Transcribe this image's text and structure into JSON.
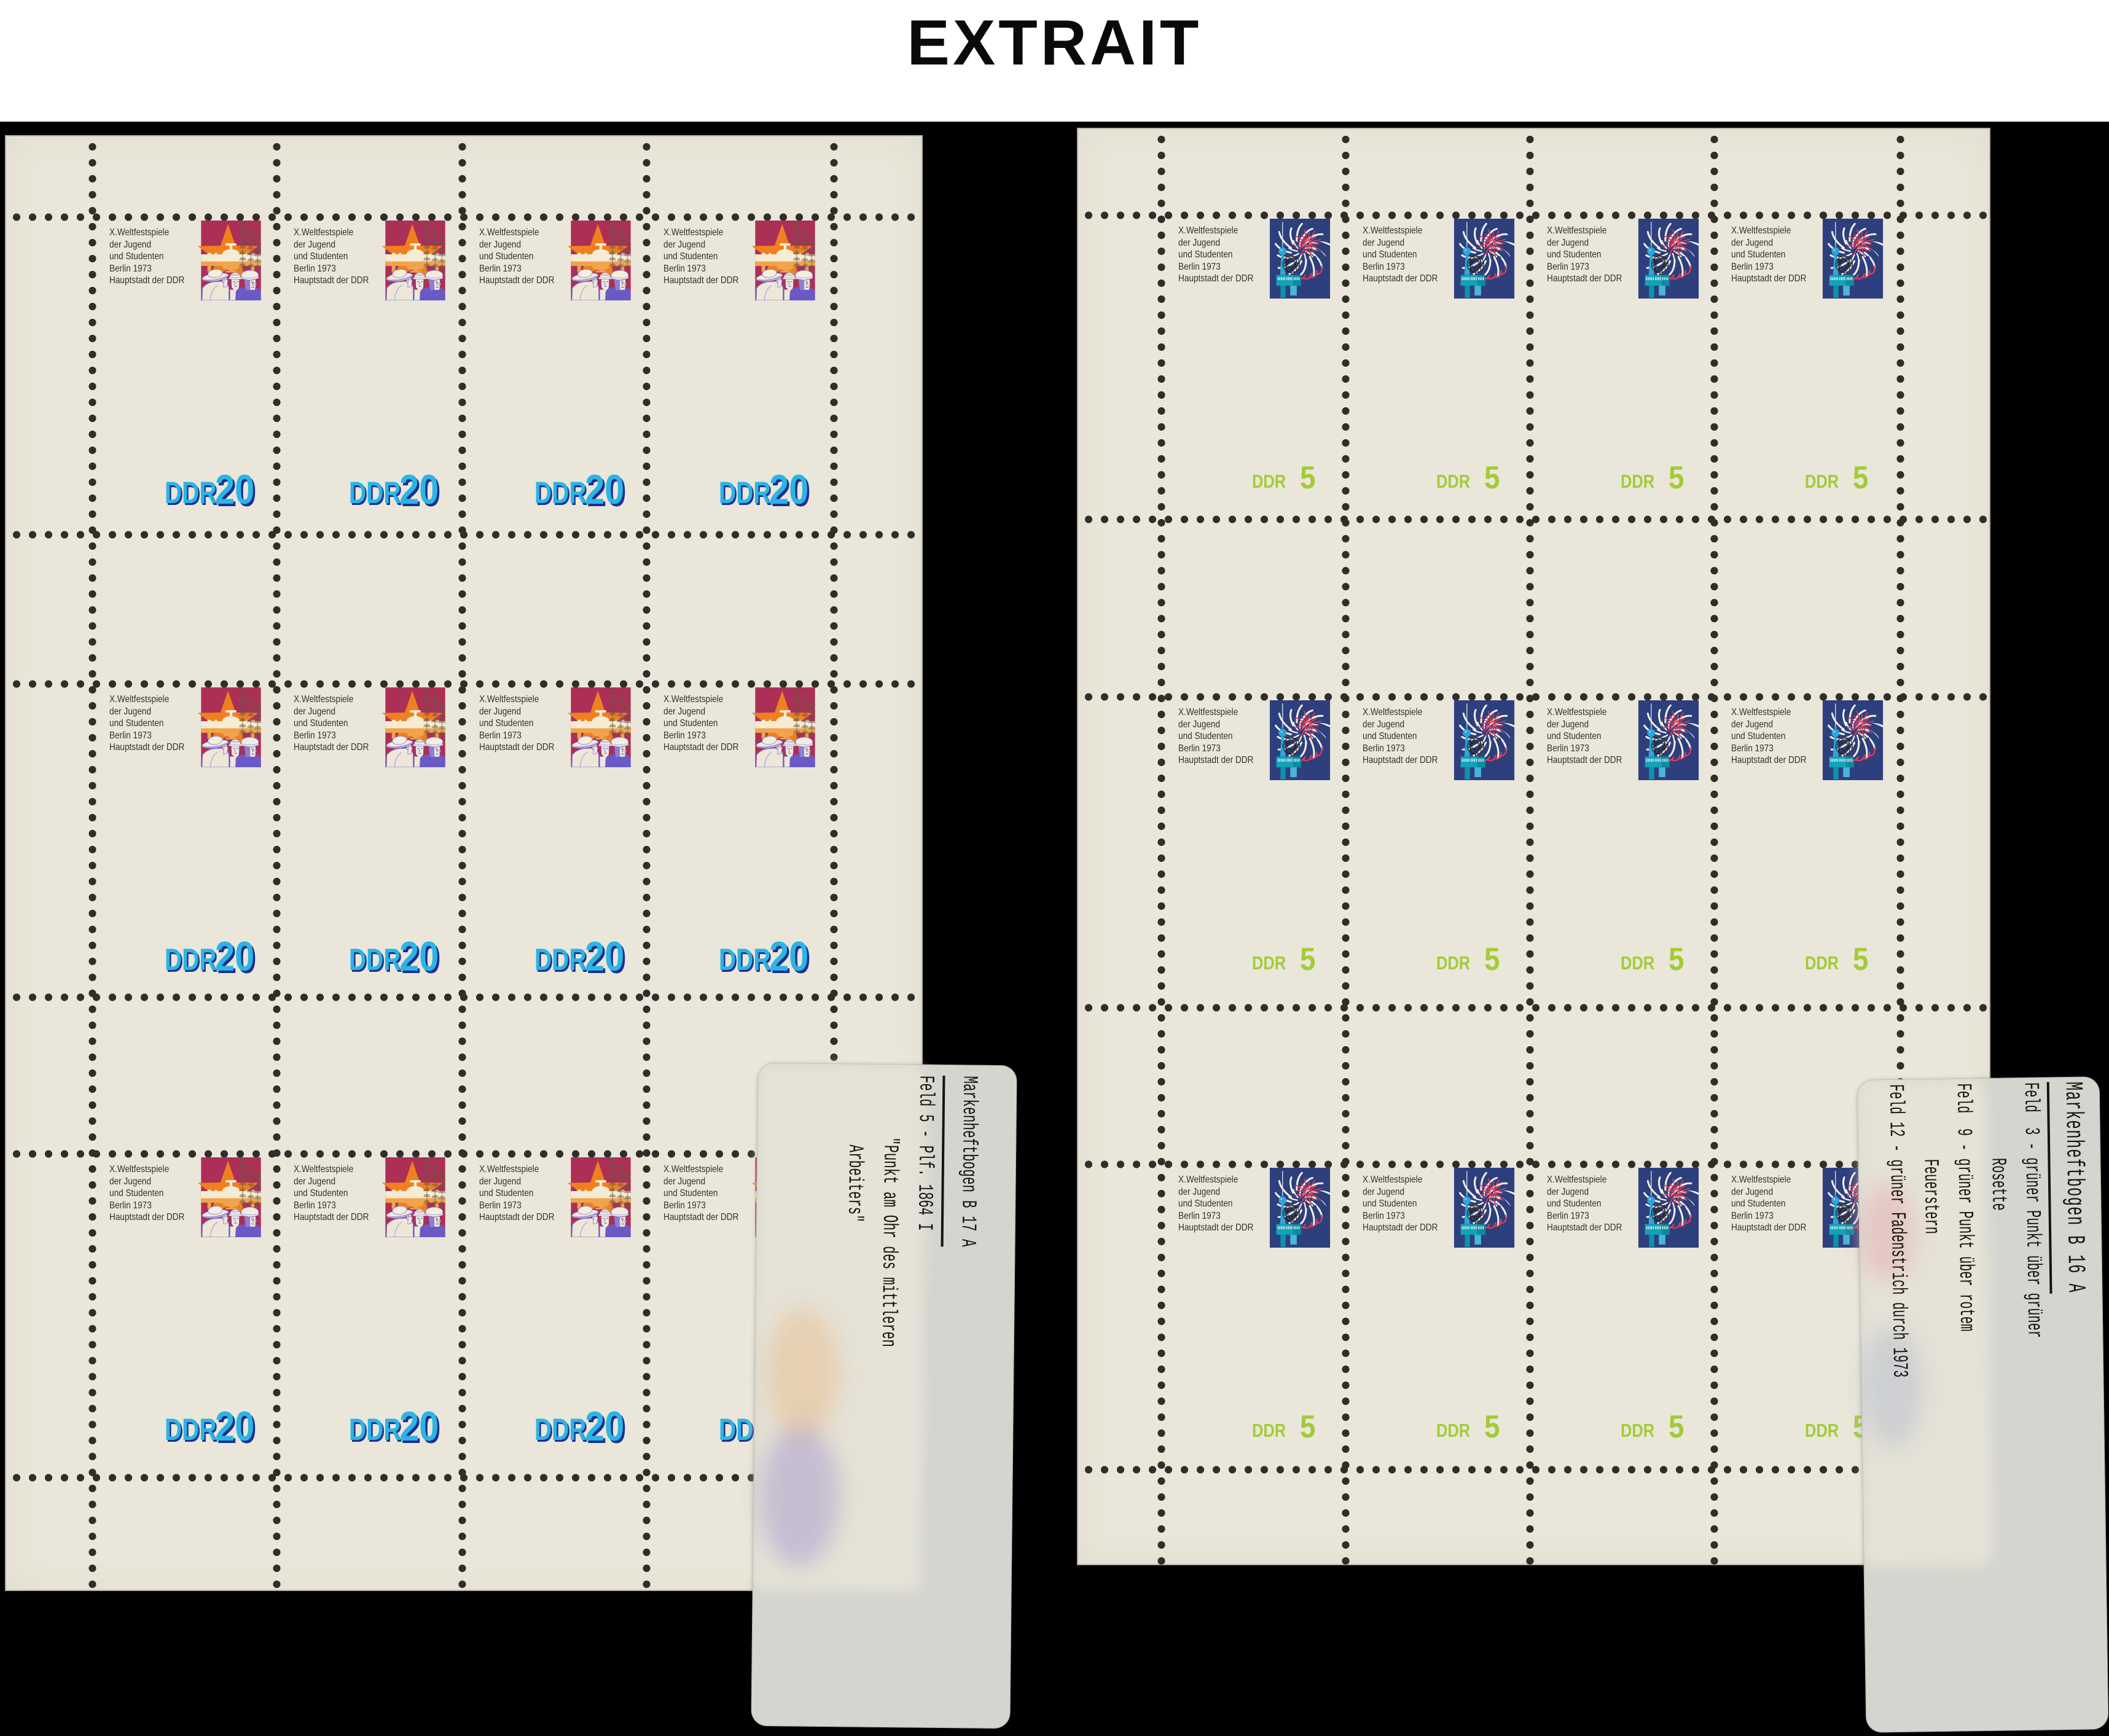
{
  "page_title": "EXTRAIT",
  "stamp": {
    "header_lines": [
      "X.Weltfestspiele",
      "der Jugend",
      "und Studenten",
      "Berlin 1973",
      "Hauptstadt der DDR"
    ],
    "country": "DDR",
    "emblem_name": "world-festival-flower-emblem"
  },
  "sheets": [
    {
      "id": "left",
      "denomination": "20",
      "rows": 3,
      "cols": 4,
      "stamp_count": 12,
      "picture": "workers-pipeline-refinery",
      "value_color": "#2cb4e4",
      "value_shadow": "#1b2f8e"
    },
    {
      "id": "right",
      "denomination": "5",
      "rows": 3,
      "cols": 4,
      "stamp_count": 12,
      "picture": "fireworks-tv-tower-world-clock",
      "value_color": "#a3cb37",
      "value_shadow": ""
    }
  ],
  "labels": [
    {
      "id": "B17A",
      "lines": [
        "Markenheftbogen B 17 A",
        "",
        "Feld 5 - Plf. 1864 I",
        "        \"Punkt am Ohr des mittleren",
        "         Arbeiters\""
      ]
    },
    {
      "id": "B16A",
      "lines": [
        "Markenheftbogen B 16 A",
        "",
        "Feld  3 - grüner Punkt über grüner",
        "          Rosette",
        "Feld  9 - grüner Punkt über rotem",
        "          Feuerstern",
        "Feld 12 - grüner Fadenstrich durch 1973"
      ]
    }
  ],
  "colors": {
    "background": "#000000",
    "header_background": "#ffffff",
    "title_color": "#0a0a0a",
    "sheet_paper": "#eae7da",
    "perforation_dot": "#2f2e2a",
    "label_card": "#d4d5cf",
    "label_text": "#15140f",
    "emblem": {
      "orange": "#f08a1d",
      "yellow": "#ecd64a",
      "green": "#94c83d",
      "cyan": "#2ba7d9",
      "magenta": "#ec4fa0"
    },
    "stamp_20": {
      "frame": "#ac2f56",
      "star": "#f0801f",
      "pipeline": "#f6ecd4",
      "reflection": "#f0a44c",
      "worker_violet": "#6b5ac5",
      "value": "#2cb4e4"
    },
    "stamp_5": {
      "navy": "#2d3f7d",
      "white": "#f3f0e4",
      "red": "#e93b55",
      "tower": "#2ea6d6",
      "base": "#12a2b8",
      "value": "#a3cb37"
    }
  }
}
